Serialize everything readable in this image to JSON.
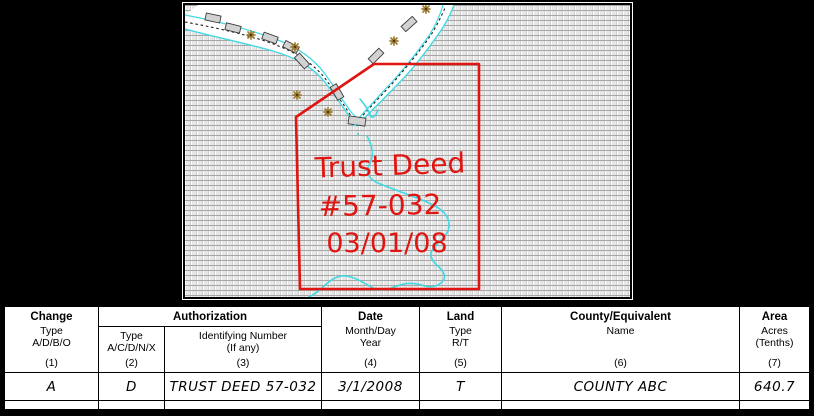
{
  "colors": {
    "red": "#e01410",
    "cyan": "#3ed9e4",
    "trail": "#1a1a1a",
    "bridge": "#d2d2d2",
    "bridge_edge": "#3a3a3a",
    "star": "#9c7b2f",
    "pattern_line": "#a6a6a6",
    "pattern_fill": "#e7e7e7"
  },
  "map": {
    "annotation": {
      "line1": "Trust Deed",
      "line2": "#57-032",
      "line3": "03/01/08"
    }
  },
  "table": {
    "change": {
      "title": "Change",
      "line2": "Type",
      "line3": "A/D/B/O",
      "num": "(1)",
      "value": "A"
    },
    "authorization": {
      "title": "Authorization",
      "type": {
        "line1": "Type",
        "line2": "A/C/D/N/X",
        "num": "(2)",
        "value": "D"
      },
      "id": {
        "line1": "Identifying Number",
        "line2": "(If any)",
        "num": "(3)",
        "value": "TRUST DEED 57-032"
      }
    },
    "date": {
      "title": "Date",
      "line2": "Month/Day",
      "line3": "Year",
      "num": "(4)",
      "value": "3/1/2008"
    },
    "land": {
      "title": "Land",
      "line2": "Type",
      "line3": "R/T",
      "num": "(5)",
      "value": "T"
    },
    "county": {
      "title": "County/Equivalent",
      "line2": "Name",
      "num": "(6)",
      "value": "COUNTY ABC"
    },
    "area": {
      "title": "Area",
      "line2": "Acres",
      "line3": "(Tenths)",
      "num": "(7)",
      "value": "640.7"
    }
  }
}
